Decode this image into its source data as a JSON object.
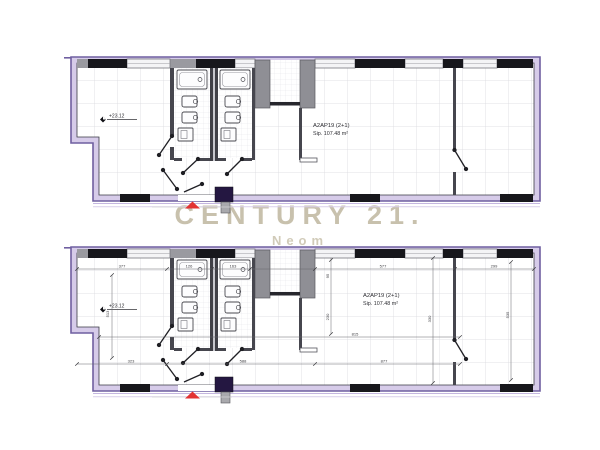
{
  "watermark": {
    "brand": "CENTURY 21.",
    "subtitle": "Neom"
  },
  "plans": {
    "top": {
      "unit": "A2AP19 (2+1)",
      "area": "Sip. 107.48 m²",
      "elevation": "+23.12"
    },
    "bottom": {
      "unit": "A2AP19 (2+1)",
      "area": "Sip. 107.48 m²",
      "elevation": "+23.12",
      "dims": {
        "d377": "377",
        "d126": "126",
        "d163": "163",
        "d577": "577",
        "d299": "299",
        "d513": "513",
        "d95": "95",
        "d230": "230",
        "d330": "330",
        "d535": "535",
        "d815": "815",
        "d877": "877",
        "d323": "323",
        "d588": "588"
      }
    }
  },
  "colors": {
    "plan_outline": "#6f5fa0",
    "wall_band": "#d6cbe9",
    "entrance_marker": "#e23333",
    "watermark_brand": "#c8c1ad",
    "watermark_subtitle": "#d1cbb9"
  }
}
